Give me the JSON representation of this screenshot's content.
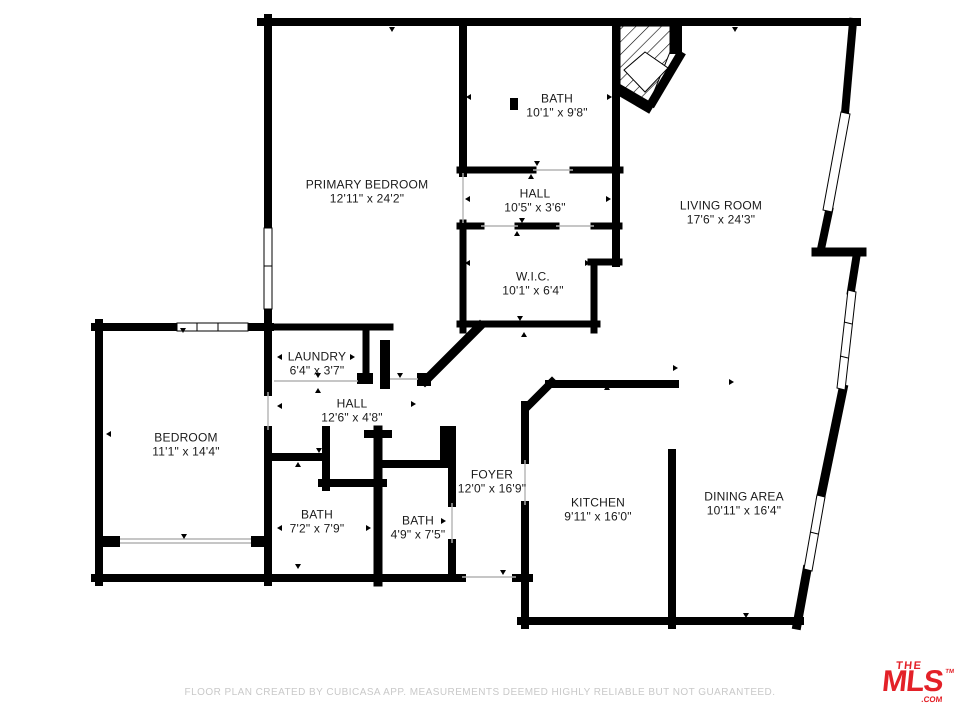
{
  "plan": {
    "rooms": [
      {
        "name": "BATH",
        "dims": "10'1\" x 9'8\"",
        "cx": 557,
        "cy": 106
      },
      {
        "name": "PRIMARY BEDROOM",
        "dims": "12'11\" x 24'2\"",
        "cx": 367,
        "cy": 192
      },
      {
        "name": "HALL",
        "dims": "10'5\" x 3'6\"",
        "cx": 535,
        "cy": 201
      },
      {
        "name": "LIVING ROOM",
        "dims": "17'6\" x 24'3\"",
        "cx": 721,
        "cy": 213
      },
      {
        "name": "W.I.C.",
        "dims": "10'1\" x 6'4\"",
        "cx": 533,
        "cy": 284
      },
      {
        "name": "LAUNDRY",
        "dims": "6'4\" x 3'7\"",
        "cx": 317,
        "cy": 364
      },
      {
        "name": "HALL",
        "dims": "12'6\" x 4'8\"",
        "cx": 352,
        "cy": 411
      },
      {
        "name": "BEDROOM",
        "dims": "11'1\" x 14'4\"",
        "cx": 186,
        "cy": 445
      },
      {
        "name": "BATH",
        "dims": "7'2\" x 7'9\"",
        "cx": 317,
        "cy": 522
      },
      {
        "name": "BATH",
        "dims": "4'9\" x 7'5\"",
        "cx": 418,
        "cy": 528
      },
      {
        "name": "FOYER",
        "dims": "12'0\" x 16'9\"",
        "cx": 492,
        "cy": 482
      },
      {
        "name": "KITCHEN",
        "dims": "9'11\" x 16'0\"",
        "cx": 598,
        "cy": 510
      },
      {
        "name": "DINING AREA",
        "dims": "10'11\" x 16'4\"",
        "cx": 744,
        "cy": 504
      }
    ]
  },
  "footer": {
    "disclaimer": "FLOOR PLAN CREATED BY CUBICASA APP. MEASUREMENTS DEEMED HIGHLY RELIABLE BUT NOT GUARANTEED."
  },
  "logo": {
    "line1": "THE",
    "line2": "MLS",
    "tm": "TM",
    "suffix": ".COM",
    "color": "#e32128"
  },
  "colors": {
    "wall": "#000000",
    "label_text": "#1a1a1a",
    "disclaimer_text": "#c9c9c9"
  }
}
